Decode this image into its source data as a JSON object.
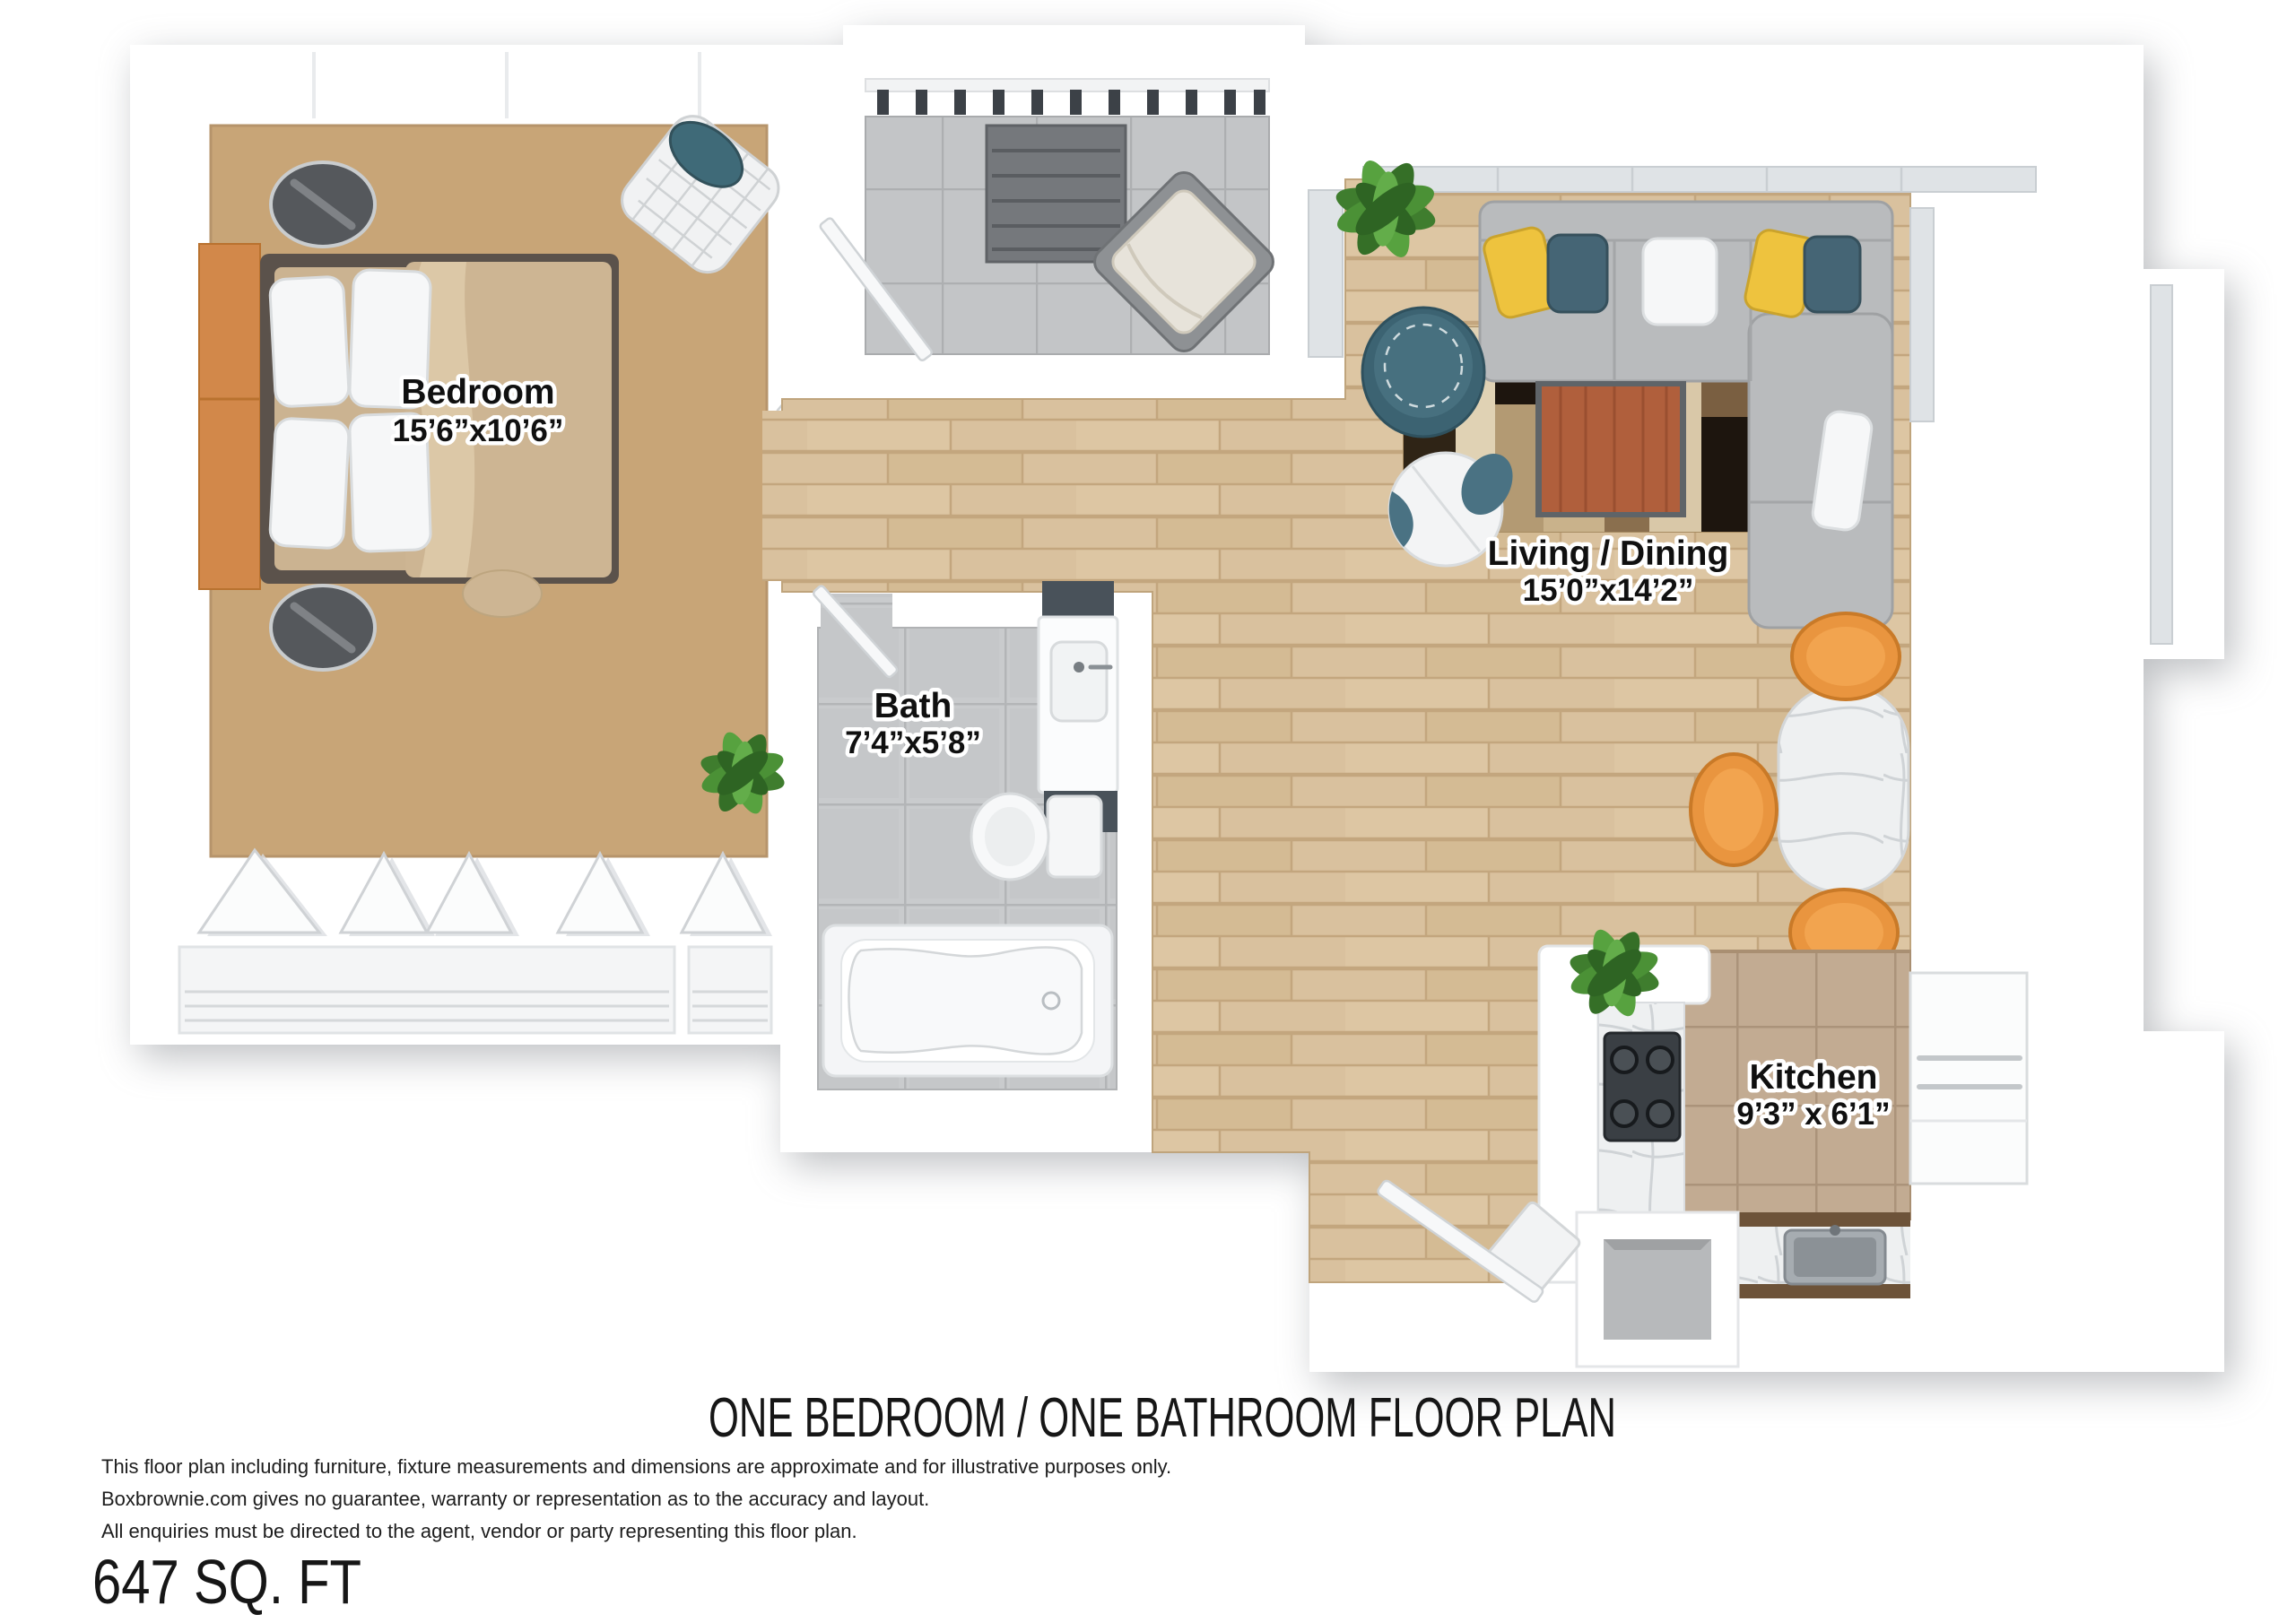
{
  "page": {
    "title": "ONE BEDROOM / ONE BATHROOM FLOOR PLAN",
    "area": "647 SQ. FT",
    "disclaimer": [
      "This floor plan including furniture, fixture measurements and dimensions are approximate and for illustrative purposes only.",
      "Boxbrownie.com gives no guarantee, warranty or representation as to the accuracy and layout.",
      "All enquiries must be directed to the agent, vendor or party representing this floor plan."
    ]
  },
  "rooms": [
    {
      "name": "Bedroom",
      "dimensions": "15’6”x10’6”"
    },
    {
      "name": "Bath",
      "dimensions": "7’4”x5’8”"
    },
    {
      "name": "Living / Dining",
      "dimensions": "15’0”x14’2”"
    },
    {
      "name": "Kitchen",
      "dimensions": "9’3” x 6’1”"
    }
  ],
  "colors": {
    "wall": "#ffffff",
    "bedroom_carpet": "#c8a577",
    "wood_floor": "#d9c19e",
    "balcony_tile": "#c3c5c7",
    "bath_tile": "#c9cbcd",
    "kitchen_tile": "#c2ab92",
    "sofa_gray": "#b9bbbd",
    "rug_base": "#c9b28b",
    "coffee_table_rust": "#b05f3c",
    "teal_accent": "#3f6a78",
    "yellow_pillow": "#eec33e",
    "orange_chair": "#e9953f",
    "headboard_orange": "#d2884a",
    "plant_green": "#3f7d2e"
  }
}
